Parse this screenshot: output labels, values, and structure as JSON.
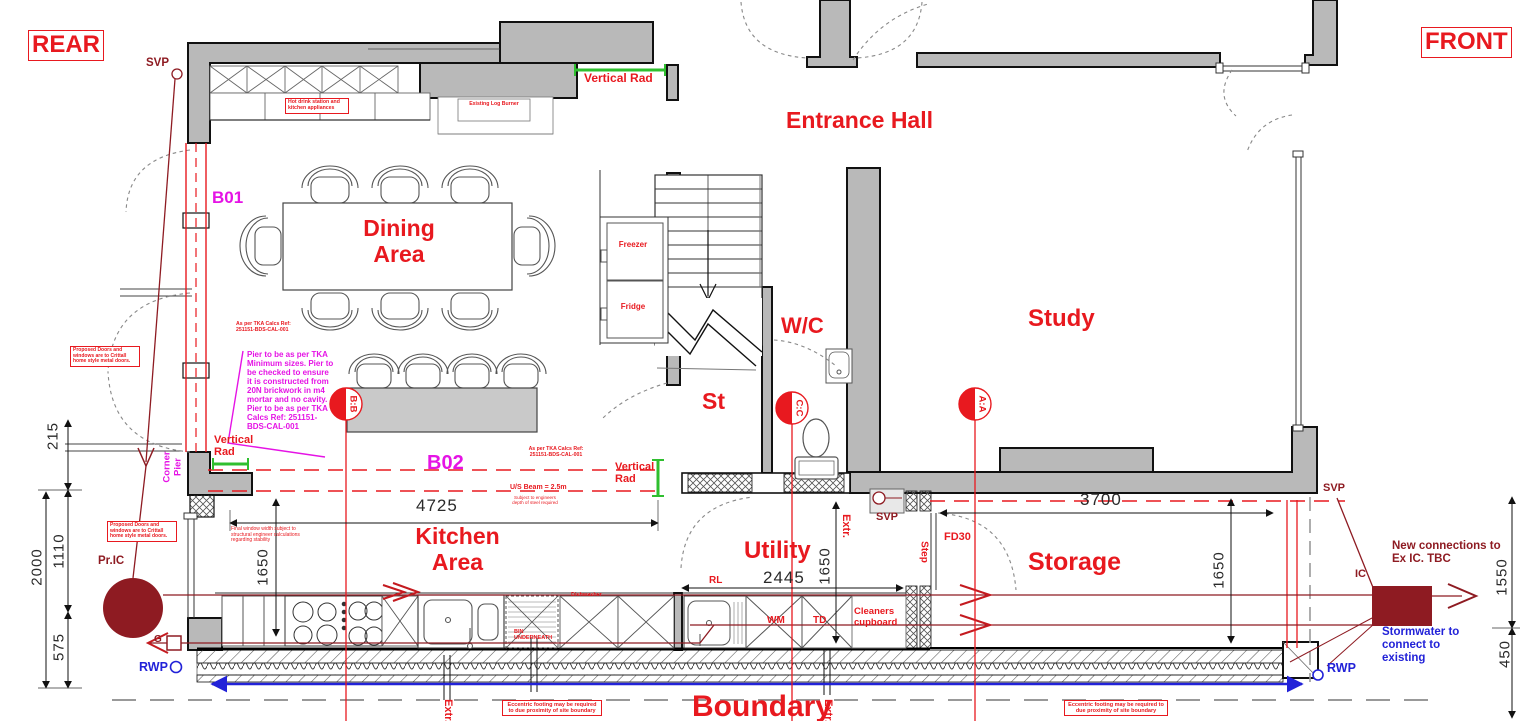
{
  "colors": {
    "wall_fill": "#b9b9b9",
    "label_red": "#e8191f",
    "service_dark_red": "#8e1b22",
    "beam_magenta": "#e513e5",
    "radiator_green": "#2fbf2f",
    "boundary_blue": "#2222d8"
  },
  "orientation": {
    "rear": "REAR",
    "front": "FRONT"
  },
  "rooms": {
    "entrance": "Entrance Hall",
    "dining": "Dining Area",
    "study": "Study",
    "wc": "W/C",
    "st": "St",
    "kitchen": "Kitchen Area",
    "utility": "Utility",
    "storage": "Storage",
    "boundary": "Boundary"
  },
  "beams": {
    "b01": "B01",
    "b02": "B02"
  },
  "sections": {
    "aa": "A:A",
    "bb": "B:B",
    "cc": "C:C"
  },
  "appliances": {
    "freezer": "Freezer",
    "fridge": "Fridge",
    "dishwasher": "Dishwasher",
    "bin": "BIN UNDERNEATH",
    "wm": "WM",
    "td": "TD",
    "cleaners": "Cleaners cupboard"
  },
  "drainage": {
    "svp_top": "SVP",
    "svp_mid": "SVP",
    "svp_right": "SVP",
    "pr_ic": "Pr.IC",
    "ic": "IC",
    "g": "G",
    "rwp_left": "RWP",
    "rwp_right": "RWP",
    "rl": "RL",
    "new_connections": "New connections to Ex IC. TBC",
    "stormwater": "Stormwater to connect to existing"
  },
  "radiators": {
    "top": "Vertical Rad",
    "left": "Vertical Rad",
    "right": "Vertical Rad"
  },
  "openings": {
    "fd30": "FD30",
    "step": "Step",
    "extr_utility": "Extr.",
    "extr_kitchen": "Extr.",
    "extr_boundary": "Extr."
  },
  "dims": {
    "d215": "215",
    "d1110": "1110",
    "d2000": "2000",
    "d575": "575",
    "d1650_kitchen": "1650",
    "d4725": "4725",
    "d2445": "2445",
    "d1650_utility": "1650",
    "d3700": "3700",
    "d1650_storage": "1650",
    "d1550": "1550",
    "d450": "450"
  },
  "notes": {
    "hot_drink": "Hot drink station and kitchen appliances",
    "log_burner": "Existing Log Burner",
    "tka_ref_top": "As per TKA Calcs Ref: 251151-BDS-CAL-001",
    "tka_ref_b02": "As per TKA Calcs Ref: 251151-BDS-CAL-001",
    "crittall_top": "Proposed Doors and windows are to Crittall home style metal doors.",
    "crittall_bottom": "Proposed Doors and windows are to Crittall home style metal doors.",
    "pier": "Pier to be as per TKA Minimum sizes. Pier to be checked to ensure it is constructed from 20N brickwork in m4 mortar and no cavity. Pier to be as per TKA Calcs Ref: 251151-BDS-CAL-001",
    "corner_pier": "Corner Pier",
    "us_beam": "U/S Beam = 2.5m",
    "us_beam_sub": "Subject to engineers depth of steel required",
    "window_width": "Final window width subject to structural engineer calculations regarding stability",
    "eccentric_left": "Eccentric footing may be required to due proximity of site boundary",
    "eccentric_right": "Eccentric footing may be required to due proximity of site boundary"
  }
}
